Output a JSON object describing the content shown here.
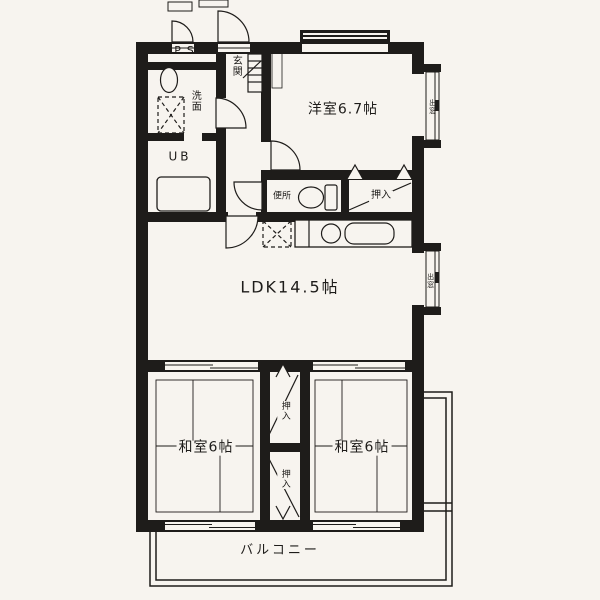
{
  "floor_plan": {
    "colors": {
      "ink": "#1e1c1a",
      "paper": "#f7f4ef"
    },
    "rooms": {
      "pipe_space": {
        "label": "P.S"
      },
      "washroom": {
        "label": "洗面"
      },
      "unit_bath": {
        "label": "UB"
      },
      "entrance": {
        "label": "玄関"
      },
      "western_room": {
        "label": "洋室6.7帖"
      },
      "toilet": {
        "label": "便所"
      },
      "ldk": {
        "label": "LDK14.5帖"
      },
      "japanese_room_left": {
        "label": "和室6帖"
      },
      "japanese_room_right": {
        "label": "和室6帖"
      },
      "balcony": {
        "label": "バルコニー"
      }
    },
    "closets": {
      "top": {
        "label": "押入"
      },
      "middle_upper": {
        "label": "押入"
      },
      "middle_lower": {
        "label": "押入"
      }
    },
    "bay_windows": {
      "western_room": {
        "label": "出窓"
      },
      "ldk": {
        "label": "出窓"
      }
    }
  }
}
